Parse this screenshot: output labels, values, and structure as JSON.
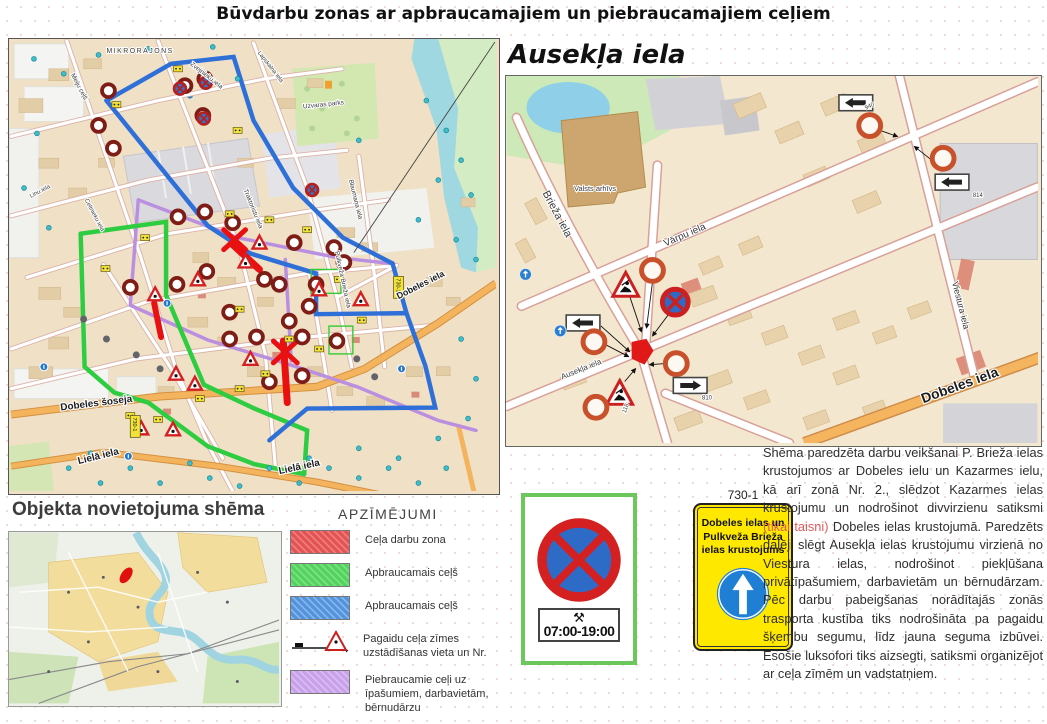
{
  "title": "Būvdarbu zonas ar apbraucamajiem un piebraucamajiem ceļiem",
  "left_map": {
    "labels": {
      "mikrorajons": "MIKRORAJONS",
      "meiju_cels": "Meiju ceļš",
      "zvejnieku_iela": "Zvejnieku iela",
      "linu_iela": "Linu iela",
      "celtnieku_iela": "Celtnieku iela",
      "traktoristu_iela": "Traktoristu iela",
      "lapskalna_iela": "Lapskalna iela",
      "blaumana_iela": "Blaumaņa iela",
      "uzvaras_parks": "Uzvaras parks",
      "brieza_iela": "Pulkveža Brieža iela",
      "dobeles_iela": "Dobeles iela",
      "dobeles_soseja": "Dobeles šoseja",
      "liela_iela": "Lielā iela",
      "plate_730": "730-1"
    }
  },
  "location_scheme": {
    "heading": "Objekta novietojuma shēma"
  },
  "legend": {
    "heading": "APZĪMĒJUMI",
    "items": [
      {
        "label": "Ceļa darbu zona",
        "color": "#e45252"
      },
      {
        "label": "Apbraucamais ceļš",
        "color": "#52d45c"
      },
      {
        "label": "Apbraucamais ceļš",
        "color": "#5293dd"
      },
      {
        "label": "Pagaidu ceļa zīmes uzstādīšanas vieta un Nr.",
        "color": "#cc2222"
      },
      {
        "label": "Piebraucamie ceļi uz īpašumiem, darbavietām, bērnudārzu",
        "color": "#c9a0ea"
      }
    ]
  },
  "signs_panel": {
    "time_plate": "07:00-19:00",
    "sign_code": "730-1",
    "yellow_sign_text": "Dobeles ielas un Pulkveža Brieža ielas krustojums"
  },
  "right_map": {
    "heading": "Ausekļa iela",
    "labels": {
      "brieza_iela": "Brieža iela",
      "varpu_iela": "Vārpu iela",
      "ausekla_iela": "Ausekļa iela",
      "viestura_iela": "Viestura iela",
      "dobeles_iela": "Dobeles iela",
      "valsts_arhivs": "Valsts arhīvs",
      "plate_940": "940",
      "plate_814": "814",
      "plate_810": "810",
      "plate_118": "118"
    }
  },
  "description": {
    "part1": "Shēma paredzēta darbu veikšanai P. Brieža ielas krustojumos ar Dobeles ielu un Kazarmes ielu, kā arī zonā Nr. 2., slēdzot Kazarmes ielas krustojumu un nodrošinot divvirzienu satiksmi ",
    "highlight": "(tikai taisni)",
    "part2": " Dobeles ielas krustojumā. Paredzēts daļēji slēgt Ausekļa ielas krustojumu virzienā no Viestura ielas, nodrošinot piekļūšana privātīpašumiem, darbavietām un bērnudārzam. Pēc darbu pabeigšanas norādītajās zonās trasporta kustība tiks nodrošināta pa pagaidu šķembu segumu, līdz jauna seguma izbūvei. Esošie luksofori tiks aizsegti, satiksmi organizējot ar ceļa zīmēm un vadstatņiem."
  },
  "colors": {
    "route_blue": "#2e6fd8",
    "route_green": "#2ecc40",
    "route_purple": "#bb8fe0",
    "work_zone_red": "#e81010",
    "sign_yellow": "#ffe800",
    "legend_red": "#e45252",
    "legend_green": "#52d45c",
    "legend_blue": "#5293dd",
    "legend_purple": "#c9a0ea"
  }
}
